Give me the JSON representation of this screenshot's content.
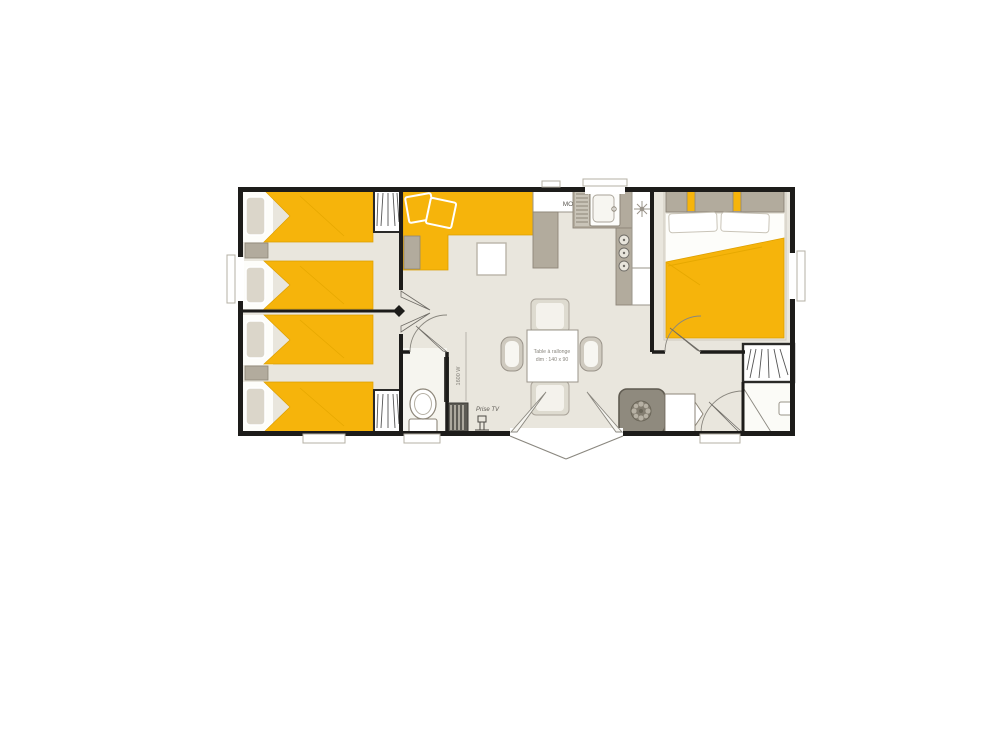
{
  "labels": {
    "microwave": "MO",
    "heater_power": "1600 W",
    "tv_outlet": "Prise TV",
    "table_label_line1": "Table à rallonge",
    "table_label_line2": "dim : 140 x 90"
  },
  "colors": {
    "background": "#ffffff",
    "wall": "#1d1c1a",
    "floor": "#e9e6dd",
    "accent_yellow": "#f6b40b",
    "accent_yellow_dark": "#dd9f00",
    "furniture_gray": "#b2ab9d",
    "furniture_gray_dark": "#8d8679",
    "appliance_dark": "#8f8a7e",
    "line_gray": "#6f6c66"
  }
}
